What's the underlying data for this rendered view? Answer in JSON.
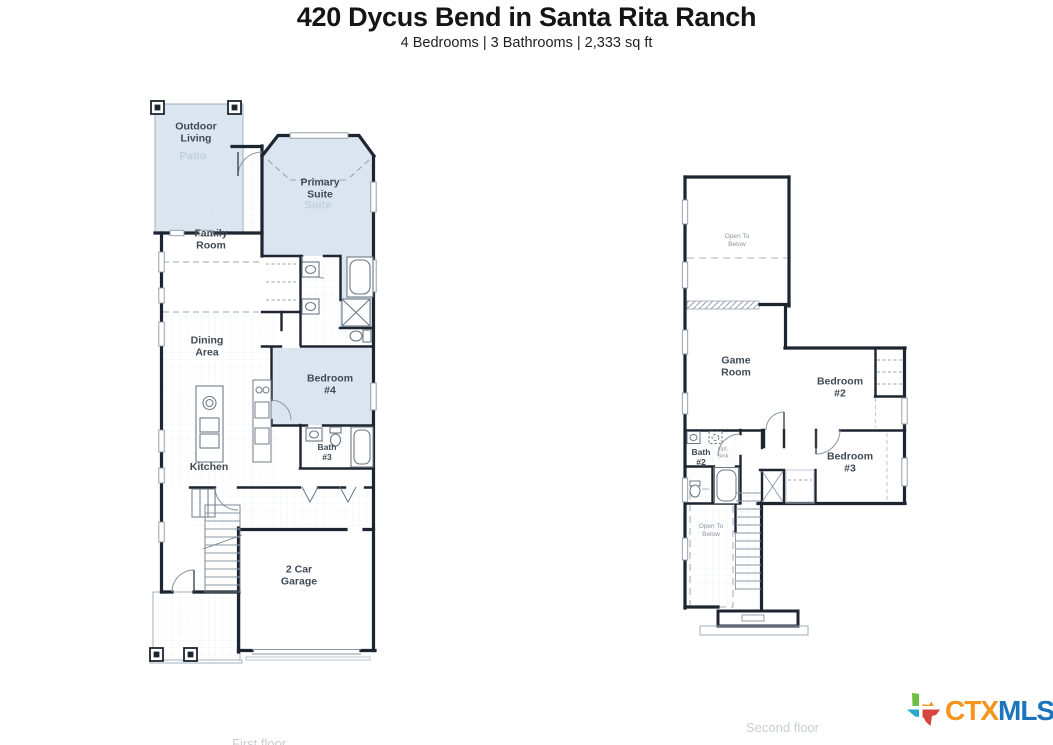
{
  "header": {
    "title": "420 Dycus Bend in Santa Rita Ranch",
    "subtitle": "4 Bedrooms | 3 Bathrooms | 2,333 sq ft"
  },
  "floors": {
    "first": {
      "caption": "First floor",
      "labels": {
        "outdoor_living": "Outdoor\nLiving",
        "patio_ghost": "Patio",
        "primary_suite": "Primary\nSuite",
        "suite_ghost": "Suite",
        "family_room": "Family\nRoom",
        "dining_area": "Dining\nArea",
        "bedroom_4": "Bedroom\n#4",
        "bath_3": "Bath\n#3",
        "kitchen": "Kitchen",
        "garage": "2 Car\nGarage"
      }
    },
    "second": {
      "caption": "Second floor",
      "labels": {
        "open_to_below_top": "Open To\nBelow",
        "game_room": "Game\nRoom",
        "bedroom_2": "Bedroom\n#2",
        "bath_2": "Bath\n#2",
        "opt_sink": "Opt.\nSink",
        "bedroom_3": "Bedroom\n#3",
        "open_to_below_stairs": "Open To\nBelow"
      }
    }
  },
  "logo": {
    "ctx": "CTX",
    "mls": "MLS"
  },
  "colors": {
    "room_highlight": "#dbe5f0",
    "wall": "#1d2531",
    "logo_orange": "#f7941d",
    "logo_blue": "#1c75bc",
    "texas_green": "#6cbe45",
    "texas_teal": "#2aa8cb",
    "texas_red": "#d8453c"
  }
}
